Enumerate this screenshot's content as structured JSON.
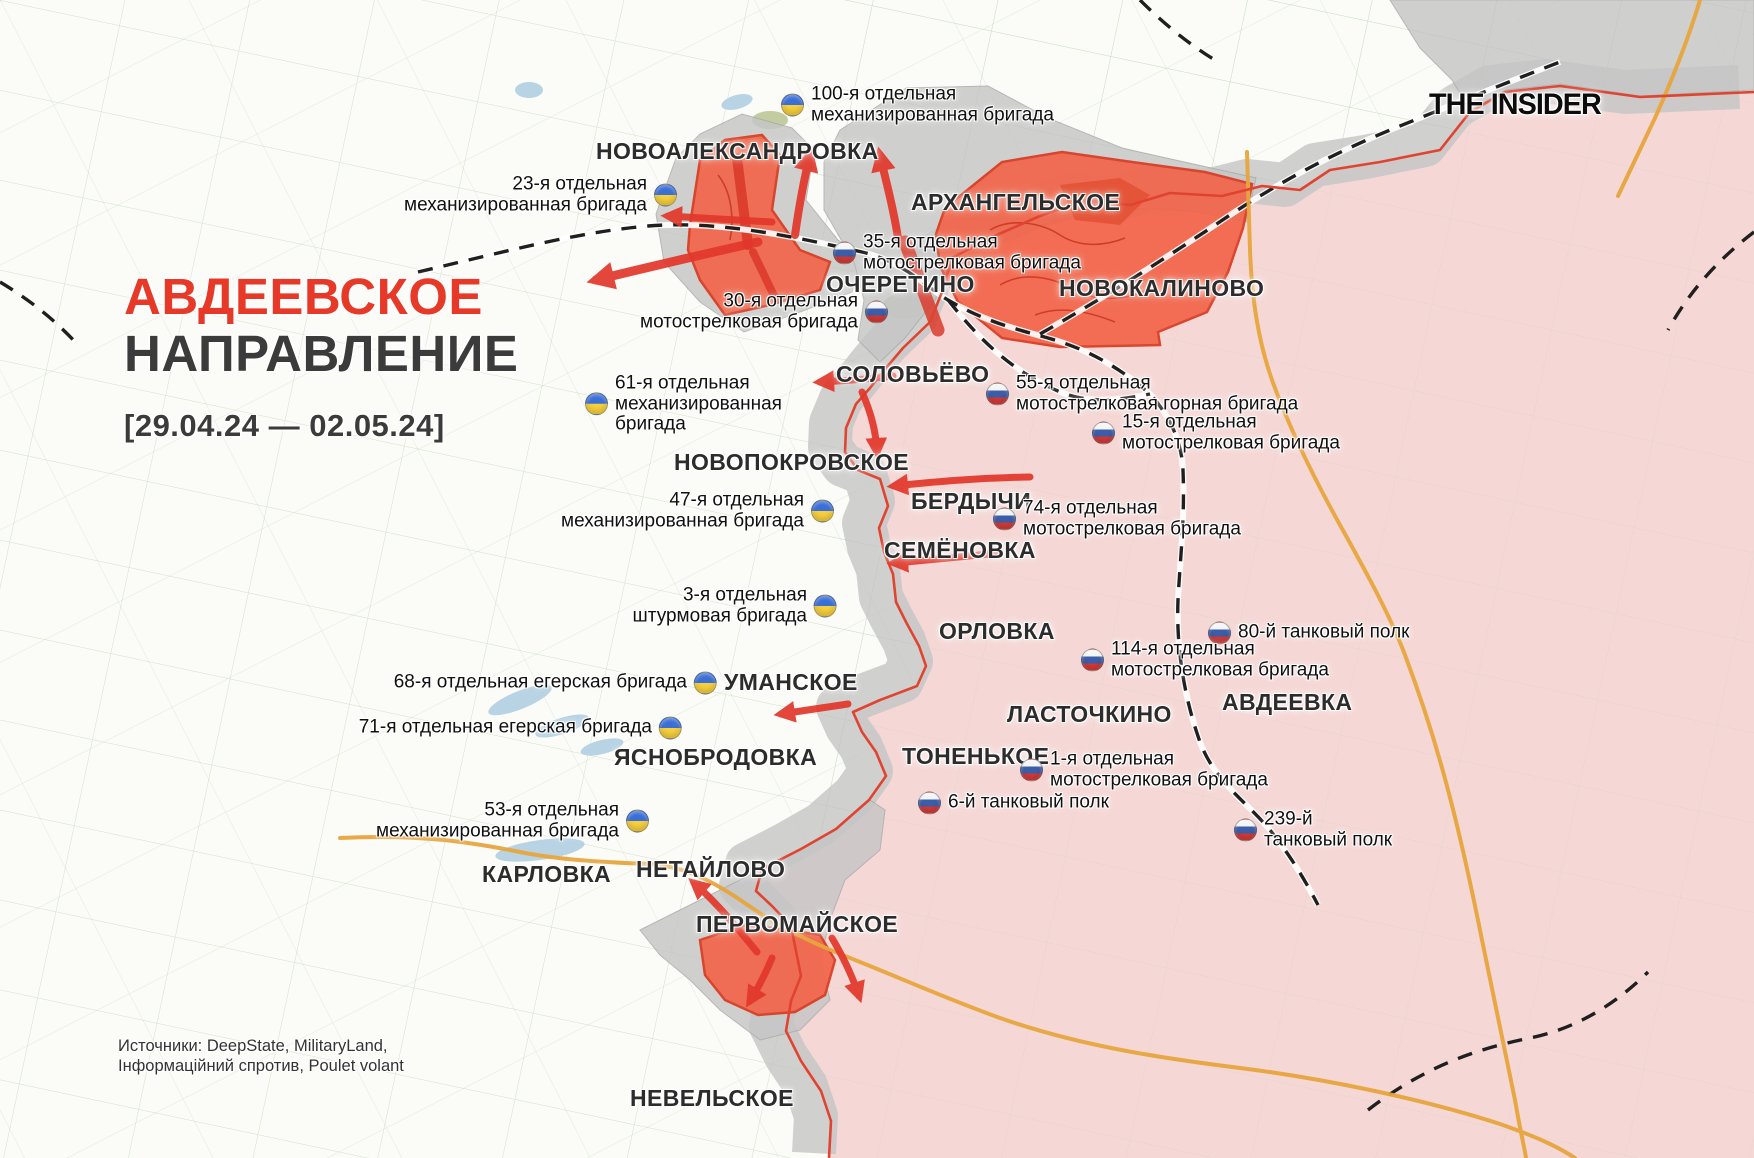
{
  "header": {
    "title_line1": "АВДЕЕВСКОЕ",
    "title_line2": "НАПРАВЛЕНИЕ",
    "date_range": "[29.04.24 — 02.05.24]"
  },
  "branding": {
    "logo_text": "THE INSIDER"
  },
  "sources": {
    "line1": "Источники: DeepState, MilitaryLand,",
    "line2": "Інформаційний спротив, Poulet volant"
  },
  "colors": {
    "title_red": "#e63928",
    "accent_red": "#e2372a",
    "front_red": "#e04330",
    "pink_zone": "#f5d8d6",
    "gray_zone": "#c6c6c6",
    "orange_advance": "#f2654a",
    "orange_advance_border": "#d93a20",
    "road_orange": "#e7a53d",
    "rail_black": "#1f1f1f",
    "field_green": "#a9c79b",
    "water_blue": "#b7d3e4",
    "forest_green": "#c3cba1",
    "ua_blue": "#3b6fd6",
    "ua_yellow": "#f7d03e",
    "ru_blue": "#3c5da8",
    "ru_red": "#d33b38"
  },
  "towns": [
    {
      "name": "НОВОАЛЕКСАНДРОВКА",
      "x": 596,
      "y": 138
    },
    {
      "name": "АРХАНГЕЛЬСКОЕ",
      "x": 911,
      "y": 189
    },
    {
      "name": "ОЧЕРЕТИНО",
      "x": 826,
      "y": 271
    },
    {
      "name": "НОВОКАЛИНОВО",
      "x": 1059,
      "y": 275
    },
    {
      "name": "СОЛОВЬЁВО",
      "x": 836,
      "y": 361
    },
    {
      "name": "НОВОПОКРОВСКОЕ",
      "x": 674,
      "y": 449
    },
    {
      "name": "БЕРДЫЧИ",
      "x": 911,
      "y": 488
    },
    {
      "name": "СЕМЁНОВКА",
      "x": 884,
      "y": 537
    },
    {
      "name": "ОРЛОВКА",
      "x": 939,
      "y": 618
    },
    {
      "name": "УМАНСКОЕ",
      "x": 724,
      "y": 669
    },
    {
      "name": "ЛАСТОЧКИНО",
      "x": 1007,
      "y": 701
    },
    {
      "name": "АВДЕЕВКА",
      "x": 1222,
      "y": 689
    },
    {
      "name": "ТОНЕНЬКОЕ",
      "x": 902,
      "y": 743
    },
    {
      "name": "ЯСНОБРОДОВКА",
      "x": 614,
      "y": 744
    },
    {
      "name": "КАРЛОВКА",
      "x": 482,
      "y": 861
    },
    {
      "name": "НЕТАЙЛОВО",
      "x": 636,
      "y": 856
    },
    {
      "name": "ПЕРВОМАЙСКОЕ",
      "x": 696,
      "y": 911
    },
    {
      "name": "НЕВЕЛЬСКОЕ",
      "x": 630,
      "y": 1085
    }
  ],
  "units": [
    {
      "lines": [
        "100-я отдельная",
        "механизированная бригада"
      ],
      "flag": "ua",
      "flag_side": "left",
      "x": 793,
      "y": 105
    },
    {
      "lines": [
        "23-я отдельная",
        "механизированная бригада"
      ],
      "flag": "ua",
      "flag_side": "right",
      "x": 665,
      "y": 195
    },
    {
      "lines": [
        "35-я отдельная",
        "мотострелковая бригада"
      ],
      "flag": "ru",
      "flag_side": "left",
      "x": 845,
      "y": 253
    },
    {
      "lines": [
        "30-я отдельная",
        "мотострелковая бригада"
      ],
      "flag": "ru",
      "flag_side": "right",
      "x": 876,
      "y": 312
    },
    {
      "lines": [
        "61-я отдельная",
        "механизированная",
        "бригада"
      ],
      "flag": "ua",
      "flag_side": "left",
      "x": 597,
      "y": 404
    },
    {
      "lines": [
        "55-я отдельная",
        "мотострелковая горная бригада"
      ],
      "flag": "ru",
      "flag_side": "left",
      "x": 998,
      "y": 394
    },
    {
      "lines": [
        "15-я отдельная",
        "мотострелковая бригада"
      ],
      "flag": "ru",
      "flag_side": "left",
      "x": 1104,
      "y": 433
    },
    {
      "lines": [
        "47-я отдельная",
        "механизированная бригада"
      ],
      "flag": "ua",
      "flag_side": "right",
      "x": 822,
      "y": 511
    },
    {
      "lines": [
        "74-я отдельная",
        "мотострелковая бригада"
      ],
      "flag": "ru",
      "flag_side": "left",
      "x": 1005,
      "y": 519
    },
    {
      "lines": [
        "3-я отдельная",
        "штурмовая бригада"
      ],
      "flag": "ua",
      "flag_side": "right",
      "x": 825,
      "y": 606
    },
    {
      "lines": [
        "80-й танковый полк"
      ],
      "flag": "ru",
      "flag_side": "left",
      "x": 1220,
      "y": 633
    },
    {
      "lines": [
        "114-я отдельная",
        "мотострелковая бригада"
      ],
      "flag": "ru",
      "flag_side": "left",
      "x": 1093,
      "y": 660
    },
    {
      "lines": [
        "68-я отдельная егерская бригада"
      ],
      "flag": "ua",
      "flag_side": "right",
      "x": 705,
      "y": 683
    },
    {
      "lines": [
        "71-я отдельная егерская бригада"
      ],
      "flag": "ua",
      "flag_side": "right",
      "x": 670,
      "y": 728
    },
    {
      "lines": [
        "1-я отдельная",
        "мотострелковая бригада"
      ],
      "flag": "ru",
      "flag_side": "left",
      "x": 1032,
      "y": 770
    },
    {
      "lines": [
        "6-й танковый полк"
      ],
      "flag": "ru",
      "flag_side": "left",
      "x": 930,
      "y": 803
    },
    {
      "lines": [
        "53-я отдельная",
        "механизированная бригада"
      ],
      "flag": "ua",
      "flag_side": "right",
      "x": 637,
      "y": 821
    },
    {
      "lines": [
        "239-й",
        "танковый полк"
      ],
      "flag": "ru",
      "flag_side": "left",
      "x": 1246,
      "y": 830
    }
  ]
}
